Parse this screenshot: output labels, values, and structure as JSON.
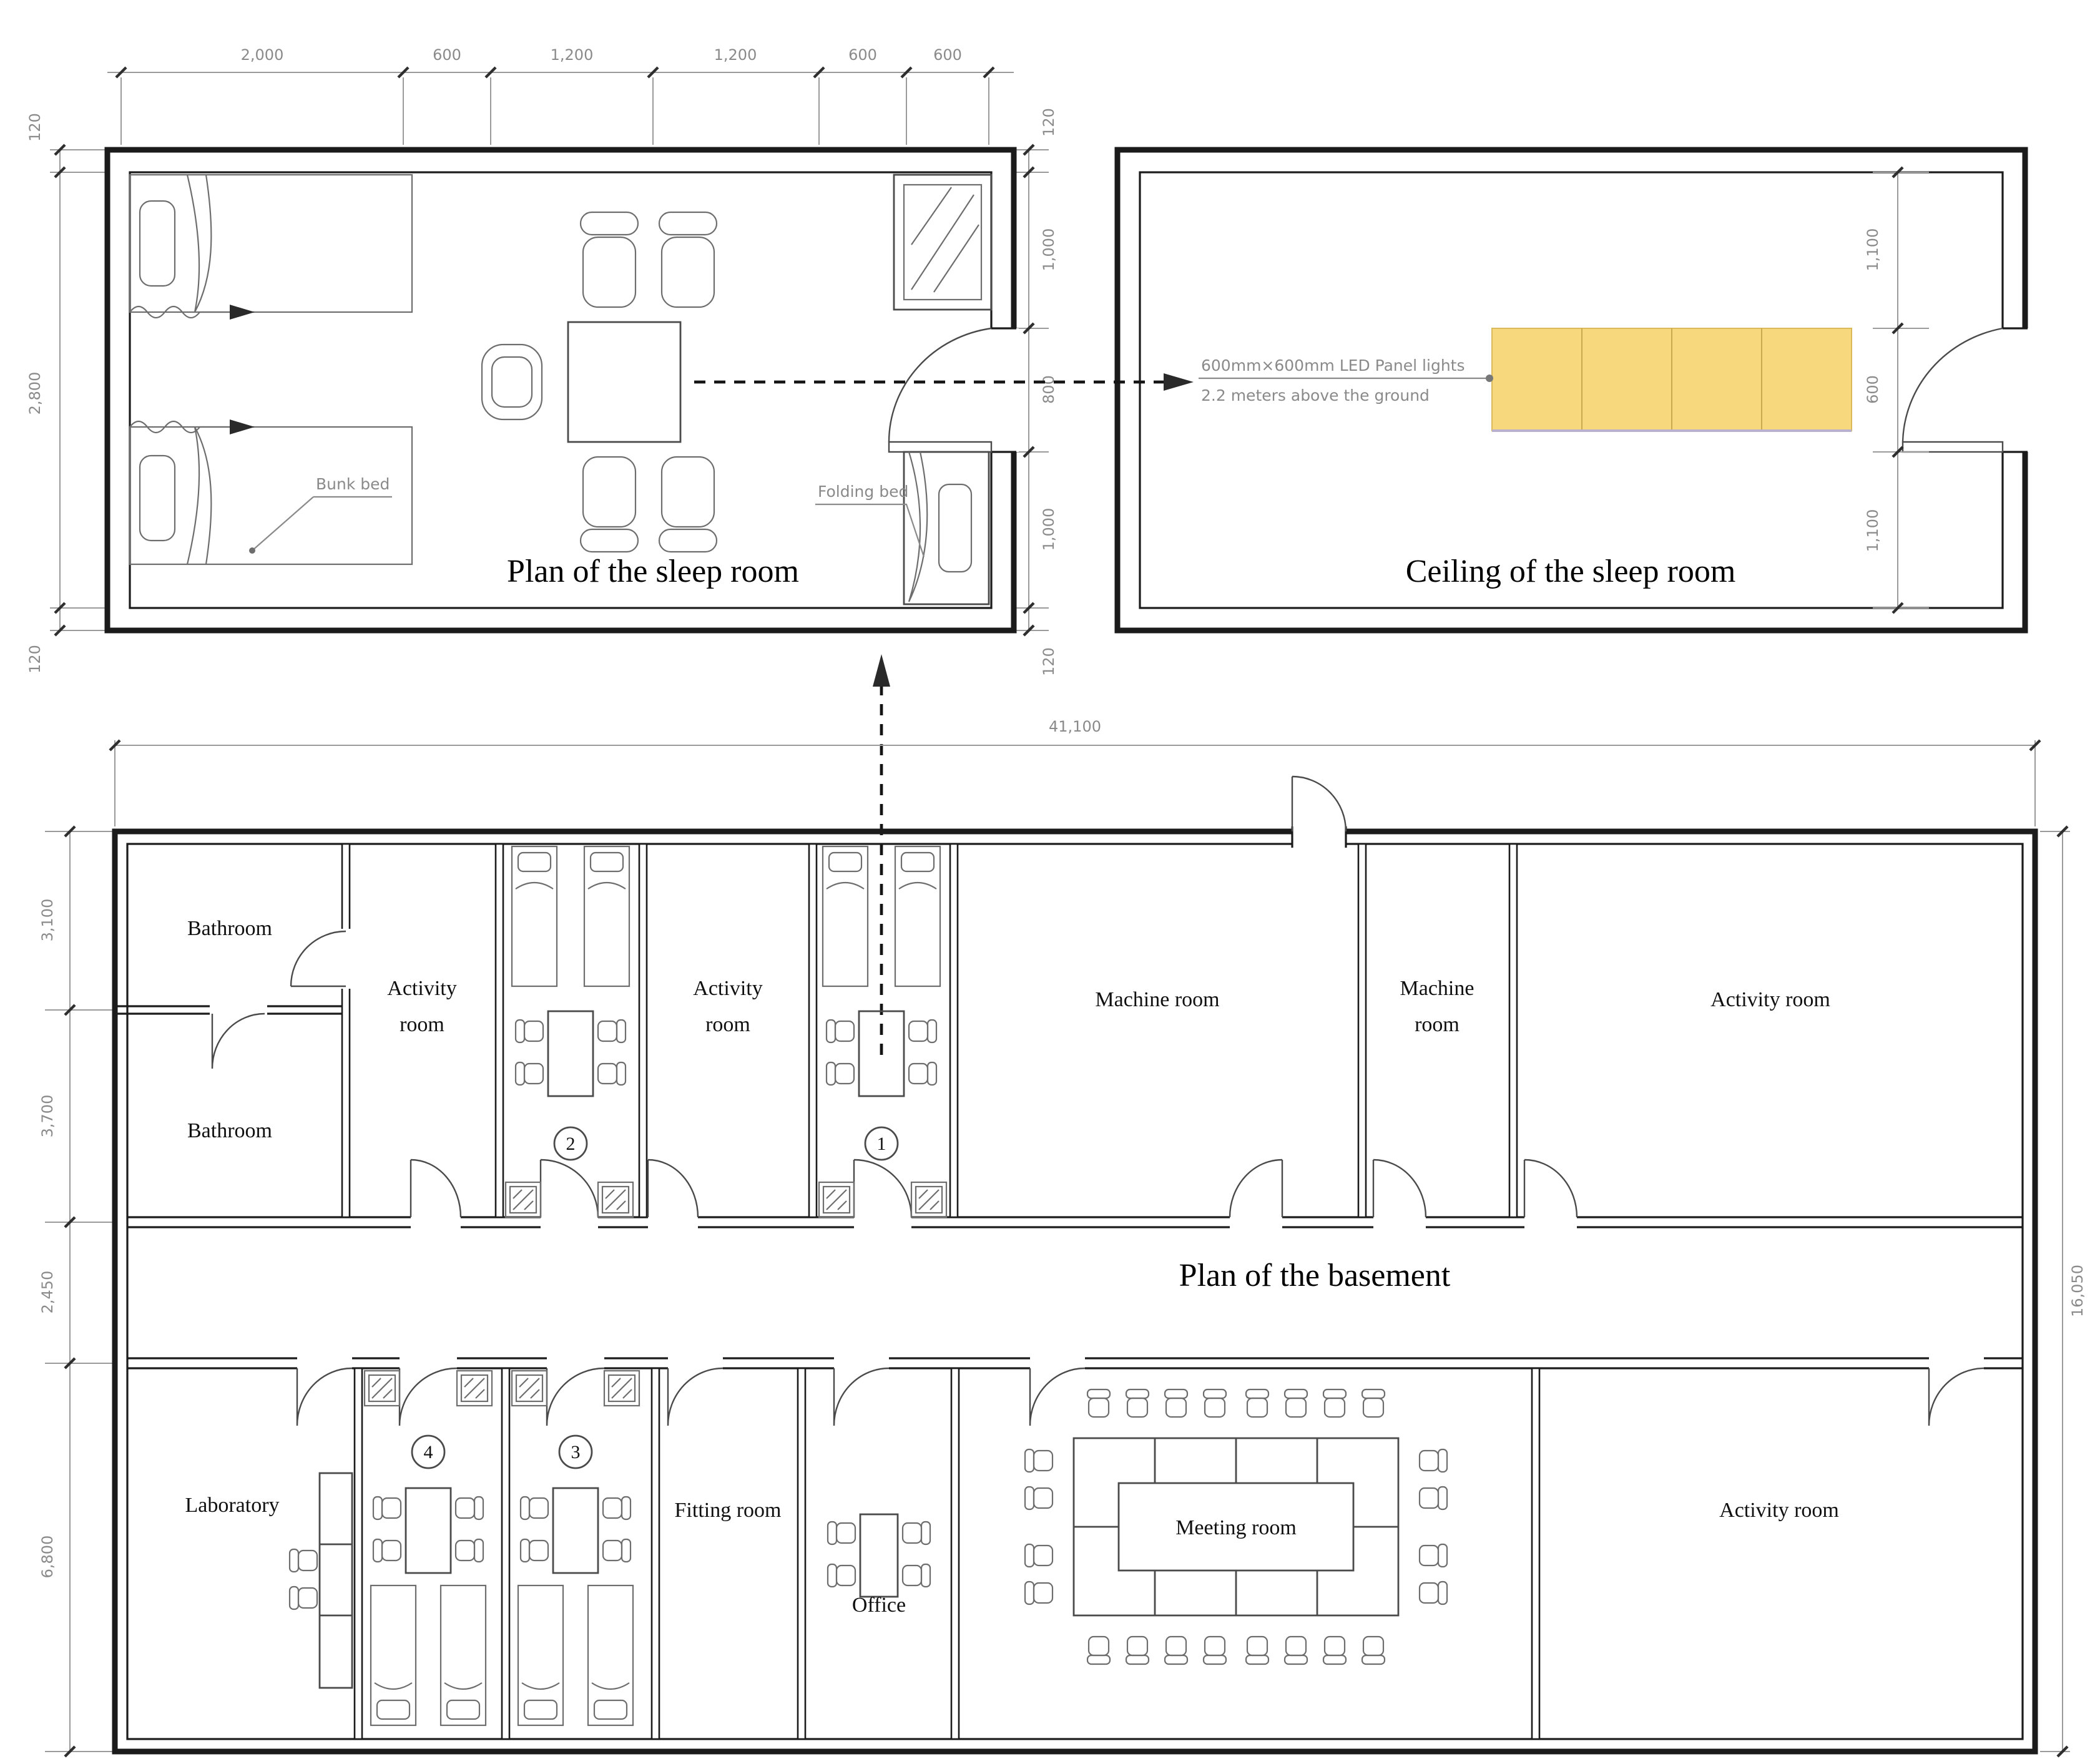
{
  "sleep_plan": {
    "title": "Plan of the sleep room",
    "dims_top": [
      "2,000",
      "600",
      "1,200",
      "1,200",
      "600",
      "600"
    ],
    "dims_left": [
      "120",
      "2,800",
      "120"
    ],
    "dims_right": [
      "120",
      "1,000",
      "800",
      "1,000",
      "120"
    ],
    "labels": {
      "bunk_bed": "Bunk bed",
      "folding_bed": "Folding bed"
    }
  },
  "ceiling_plan": {
    "title": "Ceiling of the sleep room",
    "dims_right": [
      "1,100",
      "600",
      "1,100"
    ],
    "led_note": {
      "line1": "600mm×600mm LED Panel lights",
      "line2": "2.2 meters above the ground"
    },
    "panel_color": "#F8D87C"
  },
  "basement": {
    "title": "Plan of the basement",
    "dims": {
      "width": "41,100",
      "height": "16,050",
      "left": [
        "3,100",
        "3,700",
        "2,450",
        "6,800"
      ]
    },
    "rooms": {
      "bathroom_top": "Bathroom",
      "bathroom_bottom": "Bathroom",
      "activity_1": {
        "line1": "Activity",
        "line2": "room"
      },
      "activity_2": {
        "line1": "Activity",
        "line2": "room"
      },
      "machine_large": "Machine room",
      "machine_small": {
        "line1": "Machine",
        "line2": "room"
      },
      "activity_right": "Activity room",
      "laboratory": "Laboratory",
      "fitting": "Fitting room",
      "office": "Office",
      "meeting": "Meeting room",
      "activity_bottom_right": "Activity room",
      "sleep_1": "1",
      "sleep_2": "2",
      "sleep_3": "3",
      "sleep_4": "4"
    }
  }
}
